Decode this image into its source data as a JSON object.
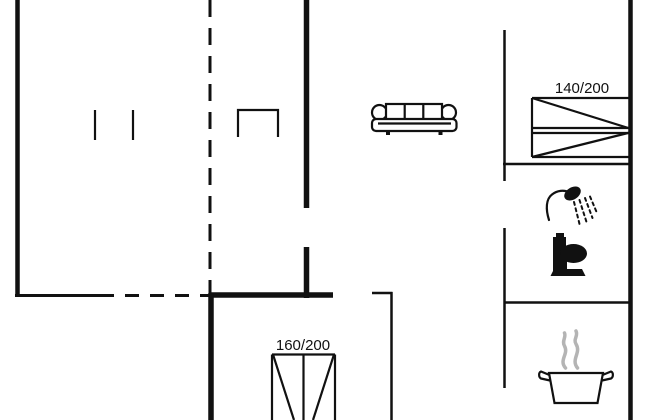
{
  "floorplan": {
    "background_color": "#ffffff",
    "line_color": "#111111",
    "steam_color": "#b4b4b4",
    "beds": [
      {
        "name": "double-bed-140",
        "size_label": "140/200"
      },
      {
        "name": "double-bed-160",
        "size_label": "160/200"
      }
    ],
    "icons": [
      "sofa-icon",
      "shower-icon",
      "toilet-icon",
      "cooking-pot-icon",
      "fireplace-icon"
    ]
  }
}
